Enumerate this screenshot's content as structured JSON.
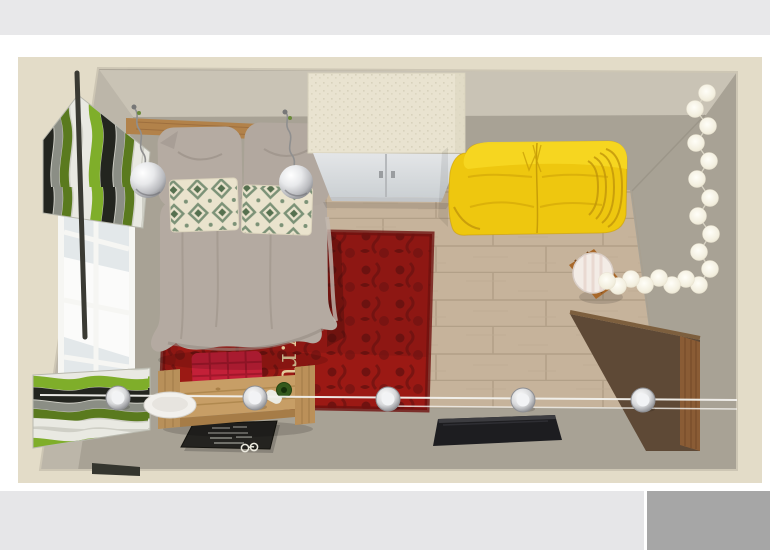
{
  "page": {
    "top_band_color": "#e8e8ea",
    "background_color": "#ffffff",
    "lower_band_color": "#e6e6e8",
    "next_image_color": "#a6a6a6"
  },
  "watermark": {
    "text": "y.ru",
    "color": "#ead9a8"
  },
  "room_render": {
    "description": "3D top-down render of a bedroom",
    "palette": {
      "wall_border": "#e3dcc8",
      "wall_top_face": "#c9c3b5",
      "wall_side_face": "#a8a295",
      "left_wall": "#bcb6a9",
      "wood_floor": "#c6b39b",
      "rug_red": "#8e1713",
      "sofa_yellow": "#eec70f",
      "bed_linen": "#b4aaa1",
      "bench_wood": "#c79e66",
      "curtain_green": "#7fae2a",
      "curtain_dark": "#23251f",
      "wardrobe_top": "#e9e3d0",
      "chalkboard": "#242320",
      "tv_black": "#1d1d20",
      "string_light_ball": "#f7f4ea",
      "chrome": "#d8d9db",
      "door_wood": "#8a5c35"
    },
    "items": [
      {
        "name": "window",
        "color": "#f6f6f3"
      },
      {
        "name": "striped-curtains",
        "color": "#7fae2a"
      },
      {
        "name": "curtain-rod",
        "color": "#3a3a33"
      },
      {
        "name": "headboard-shelf",
        "color": "#b2824a"
      },
      {
        "name": "pendant-lamps",
        "count": 2,
        "color": "#b9babe"
      },
      {
        "name": "bed-with-duvet",
        "color": "#b4aaa1"
      },
      {
        "name": "pillows",
        "count": 2,
        "color": "#b5aba2"
      },
      {
        "name": "kilim-cushions",
        "count": 2,
        "color": "#7c9277"
      },
      {
        "name": "red-rug",
        "color": "#8e1713"
      },
      {
        "name": "red-check-cushion",
        "color": "#c32038"
      },
      {
        "name": "wardrobe",
        "color": "#e9e3d0"
      },
      {
        "name": "yellow-sofa",
        "color": "#eec70f"
      },
      {
        "name": "round-side-table",
        "color": "#a8682a"
      },
      {
        "name": "string-light-garland",
        "ball_count": 19,
        "color": "#f7f4ea"
      },
      {
        "name": "cable-spotlights",
        "count": 5,
        "color": "#d8d9db"
      },
      {
        "name": "wooden-bench",
        "color": "#c79e66"
      },
      {
        "name": "serving-plate",
        "color": "#f2f0ec"
      },
      {
        "name": "bottle",
        "color": "#33591c"
      },
      {
        "name": "chalkboard-sign",
        "color": "#242320"
      },
      {
        "name": "eyeglasses",
        "color": "#eceadf"
      },
      {
        "name": "tv-screen",
        "color": "#1d1d20"
      },
      {
        "name": "open-door-panel",
        "color": "#8a5c35"
      },
      {
        "name": "wood-floor",
        "color": "#c6b39b"
      }
    ]
  }
}
